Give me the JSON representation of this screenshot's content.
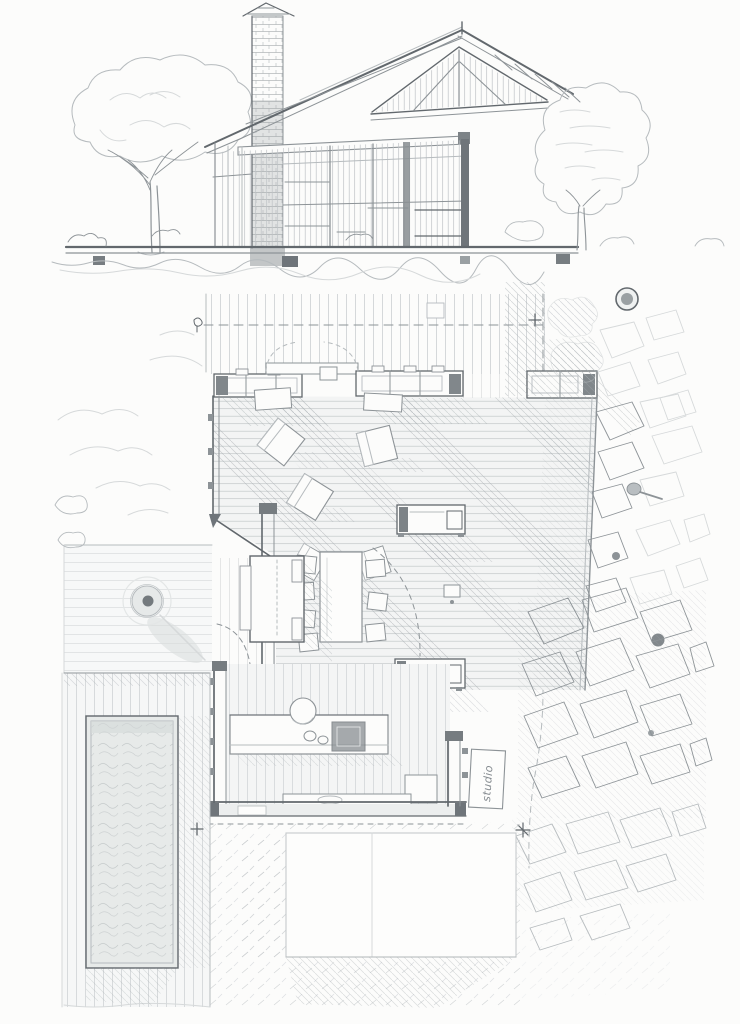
{
  "annotations": {
    "studio_label": "studio",
    "plus_marker": "+",
    "star_marker": "✳"
  },
  "icons": {
    "plus-marker-top": "survey cross mark on dashed boundary line",
    "plus-marker-left": "survey cross mark at pool deck wall",
    "star-marker": "hand-drawn asterisk on stone paving",
    "fire-pit": "round fire bowl on terrace",
    "sink": "double kitchen sink circles",
    "cooktop": "dark stove square on counter"
  },
  "palette": {
    "paper": "#fcfcfb",
    "pencil_dark": "#62686d",
    "pencil_mid": "#8d9397",
    "pencil_light": "#b6bbbe",
    "pencil_faint": "#d6d9da",
    "shadow_wash": "#a6acb0"
  }
}
